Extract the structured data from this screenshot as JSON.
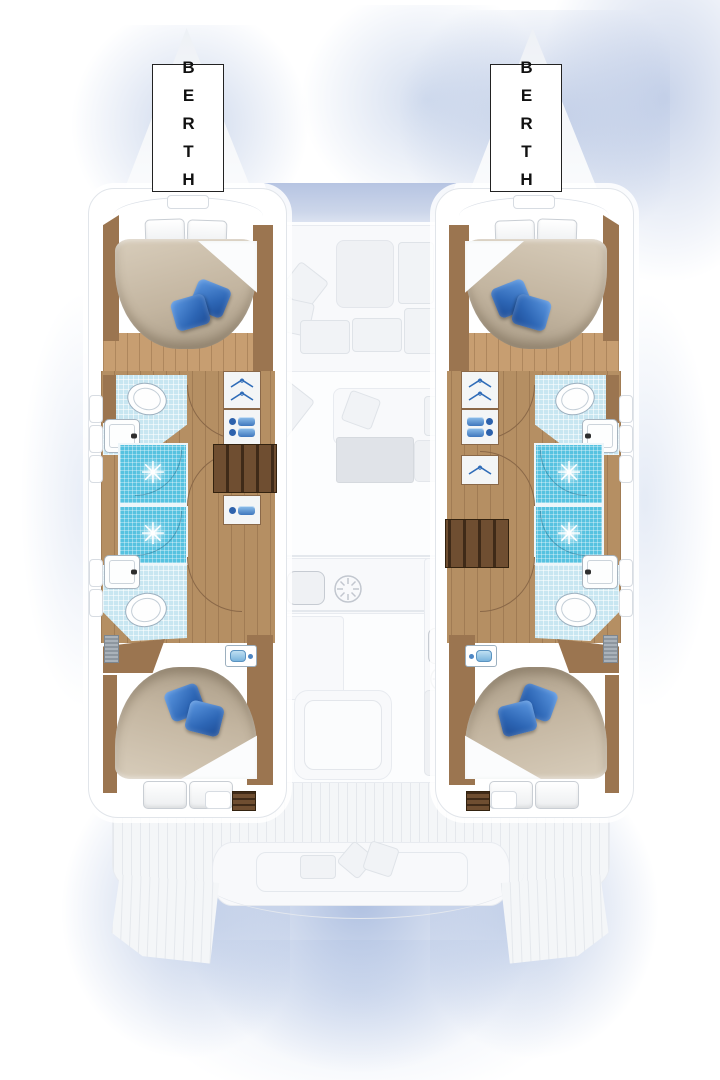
{
  "diagram": {
    "type": "catamaran-interior-floor-plan",
    "view": "overhead deck / accommodation layout",
    "hulls": 2,
    "cabins_per_hull": 2,
    "heads_per_hull": 2,
    "showers_per_hull": 2
  },
  "labels": {
    "port_berth": "BERTH",
    "starboard_berth": "BERTH"
  },
  "icons": {
    "shower_drain_glyph": "✳"
  },
  "palette": {
    "hull_line": "#e1e5ea",
    "wood_trim": "#9b7550",
    "wood_floor": "#c79e71",
    "walkway_wood": "#b58f63",
    "wood_steps": "#5c4128",
    "tile_blue": "#c8e6f1",
    "shower_blue": "#56c2e0",
    "pillow_blue_a": "#5e9ae3",
    "pillow_blue_b": "#1c4a93",
    "duvet_taupe": "#c3b5a0",
    "ghost_fill": "#f8f9fb",
    "ghost_line": "#e8ebf0",
    "water_glow": "#7f9ed3",
    "label_border": "#222222",
    "label_text": "#111111"
  }
}
